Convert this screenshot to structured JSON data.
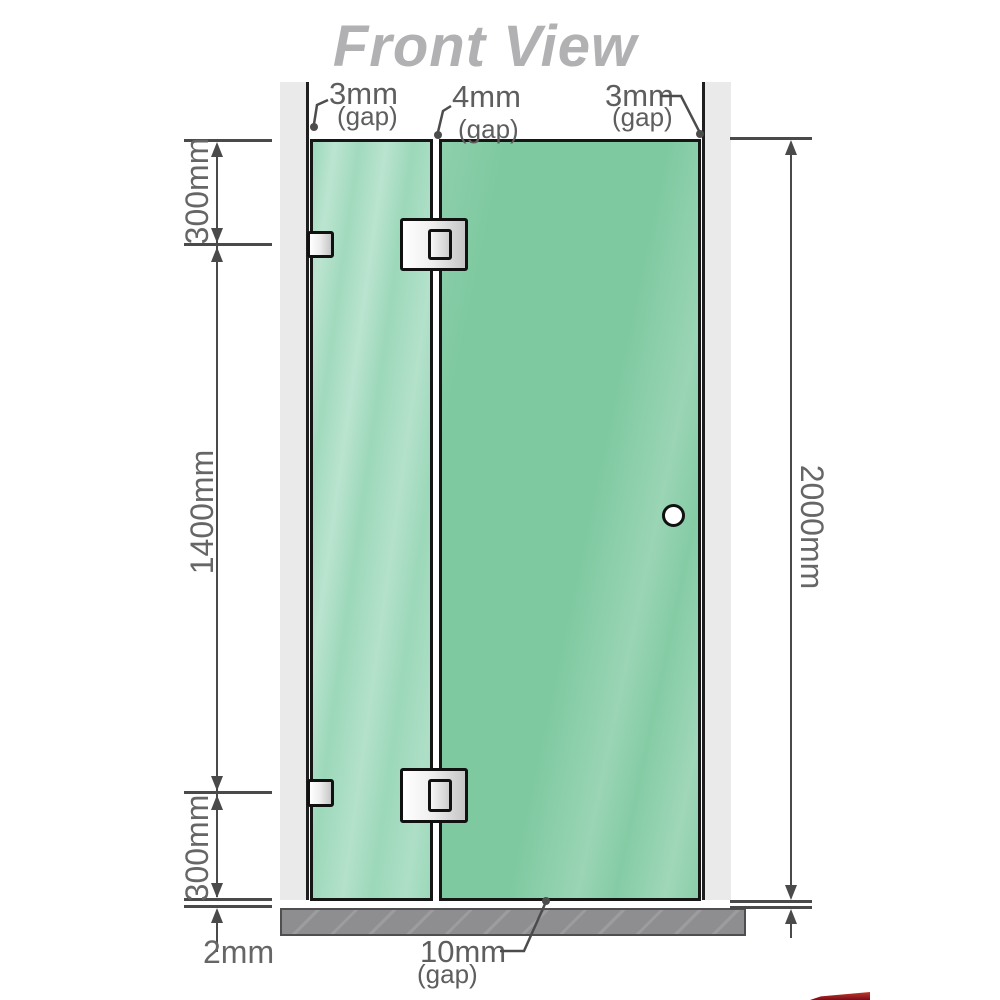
{
  "title": "Front View",
  "gap_labels": {
    "top_left": {
      "value": "3mm",
      "suffix": "(gap)"
    },
    "top_center": {
      "value": "4mm",
      "suffix": "(gap)"
    },
    "top_right": {
      "value": "3mm",
      "suffix": "(gap)"
    },
    "bottom_center": {
      "value": "10mm",
      "suffix": "(gap)"
    }
  },
  "dimensions": {
    "left_top": "300mm",
    "left_middle": "1400mm",
    "left_bottom": "300mm",
    "floor_gap": "2mm",
    "right_overall": "2000mm"
  },
  "colors": {
    "glass_left_panel": "#9cd8ba",
    "glass_right_door": "#7ec9a0",
    "wall": "#eaeaea",
    "floor": "#8e8e90",
    "dimension_lines": "#4a4a4a",
    "label_text": "#666666",
    "title_text": "#b1b1b4",
    "hardware_outline": "#111111",
    "logo_fragment_red": "#7a0c18"
  }
}
